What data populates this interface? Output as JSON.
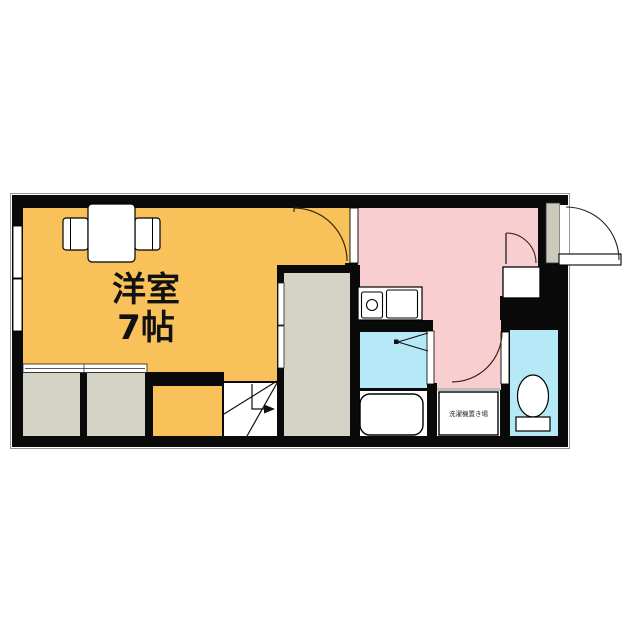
{
  "plan": {
    "type": "floor-plan",
    "rooms": {
      "western_room": {
        "label_line1": "洋室",
        "label_line2": "7帖"
      },
      "washer_space": {
        "label": "洗濯機置き場"
      }
    },
    "icons": {
      "table_chairs": "dining-table-with-two-chairs",
      "kitchen_sink": "two-basin-sink-with-faucet",
      "bathtub": "bathtub",
      "toilet": "toilet-bowl-with-tank",
      "stairs": "staircase-up-arrow",
      "entrance": "entrance-door-swing",
      "folding_door": "bathroom-folding-door",
      "window": "wall-window"
    }
  },
  "colors": {
    "wall": "#0a0a0a",
    "room_orange": "#f9c159",
    "room_pink": "#f9ced1",
    "room_cyan": "#b5e9f8",
    "closet_gray": "#d5d3c6",
    "door_gray": "#cbc9bb",
    "outline_gray": "#9a9a9a",
    "white": "#ffffff"
  }
}
